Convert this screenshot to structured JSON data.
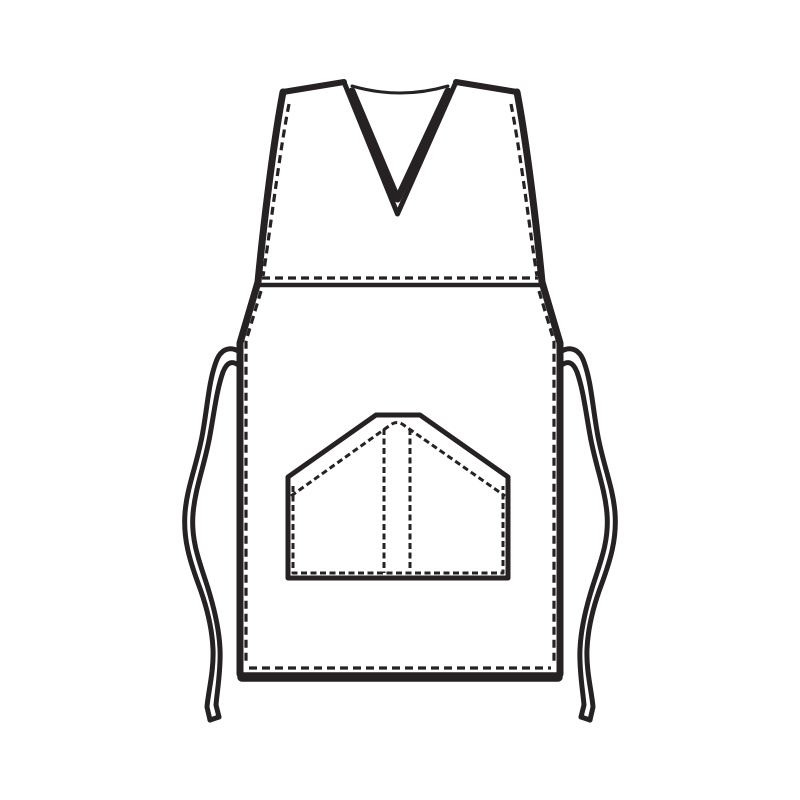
{
  "figure": {
    "kind": "line-art-technical-flat",
    "subject": "v-neck bib apron with waist ties and divided front pocket",
    "parts": [
      "shoulder-straps",
      "v-neck-band",
      "back-neck-curve",
      "bib",
      "waist-seam",
      "skirt",
      "waist-tie-left",
      "waist-tie-right",
      "front-pocket",
      "pocket-pen-divider",
      "edge-stitching",
      "hem-stitching"
    ]
  },
  "colors": {
    "ink": "#262223",
    "background": "#ffffff"
  }
}
